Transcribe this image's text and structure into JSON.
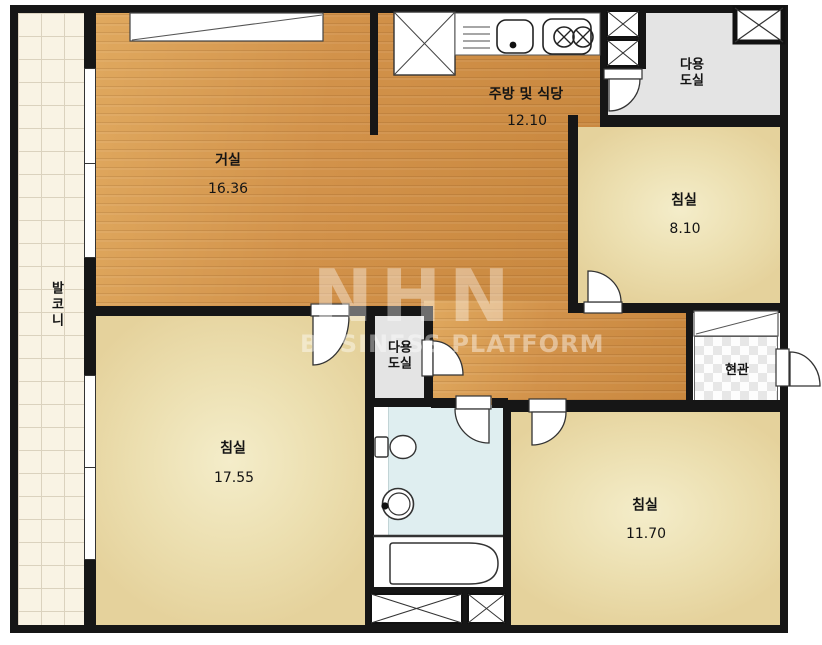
{
  "plan": {
    "rooms": {
      "living_room": {
        "label": "거실",
        "area": "16.36"
      },
      "kitchen_dining": {
        "label": "주방 및 식당",
        "area": "12.10"
      },
      "utility_top_right": {
        "line1": "다용",
        "line2": "도실"
      },
      "utility_center": {
        "line1": "다용",
        "line2": "도실"
      },
      "bedroom_top_right": {
        "label": "침실",
        "area": "8.10"
      },
      "bedroom_bottom_left": {
        "label": "침실",
        "area": "17.55"
      },
      "bedroom_bottom_right": {
        "label": "침실",
        "area": "11.70"
      },
      "balcony": {
        "label": "발코니"
      },
      "entrance": {
        "label": "현관"
      }
    },
    "watermark": {
      "logo": "NHN",
      "subtitle": "BUSINESS PLATFORM"
    },
    "colors": {
      "wall": "#161616",
      "wood_floor": "#d2924a",
      "bedroom_floor": "#ecdfb0",
      "utility_floor": "#e4e4e4",
      "bathroom_floor": "#dfeef0",
      "balcony_tile": "#f9f3e4"
    }
  }
}
